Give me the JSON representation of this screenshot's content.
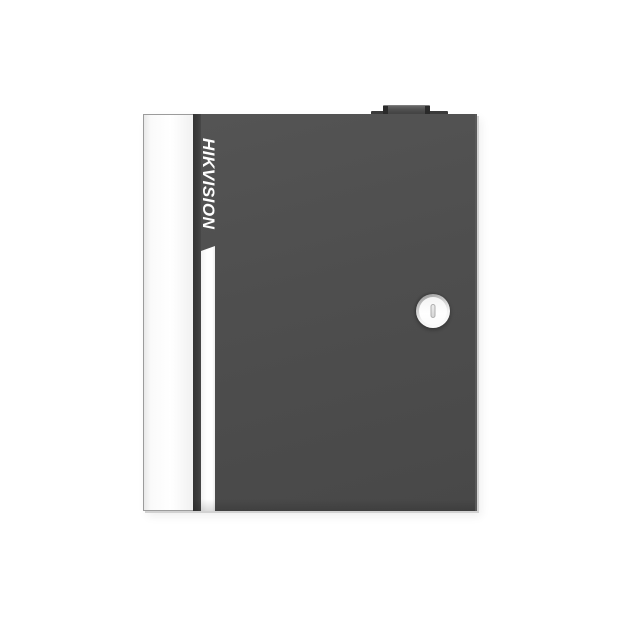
{
  "image": {
    "description": "Product photo of a wall-mount metal enclosure on a plain white background",
    "background_color": "#ffffff"
  },
  "device": {
    "brand": "HIKVISION",
    "features": {
      "top_knob": "cable knock-out tab",
      "lock": "round cam lock with vertical keyhole slot",
      "accent_stripe": "white vertical stripe with slanted top",
      "side_panel": "white hinge-side edge panel"
    },
    "colors": {
      "door_face": "#4e4e4e",
      "door_edge": "#3d3d3d",
      "side_panel": "#fafafa",
      "accent_stripe": "#ffffff",
      "logo_text": "#ffffff",
      "knob": "#4f4f4f",
      "knob_cap": "#2b2b2b",
      "lock_ring": "#8e8e8e",
      "lock_face": "#ffffff",
      "keyhole": "#d6d6d6",
      "edge_shadow": "#d2d2d2"
    }
  }
}
